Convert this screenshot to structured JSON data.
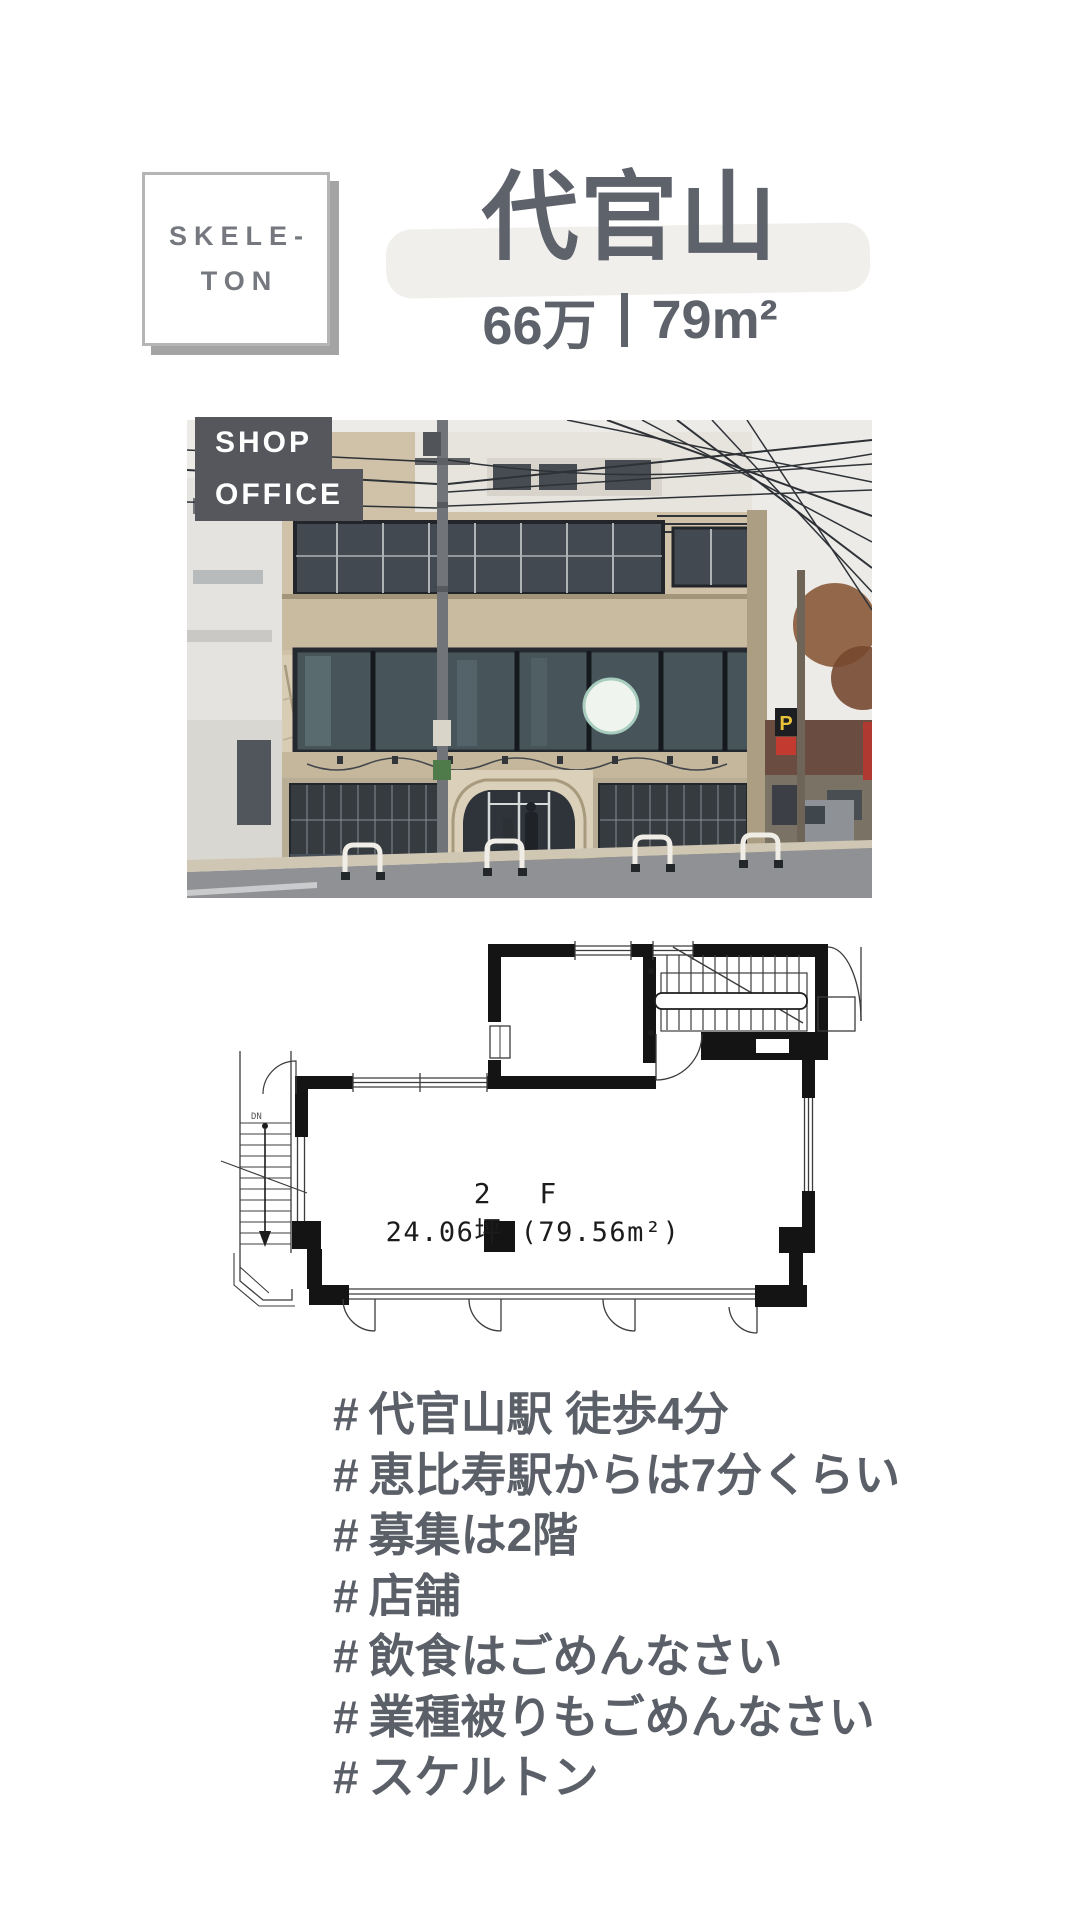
{
  "colors": {
    "text": "#5a5f68",
    "title_text": "#5e626b",
    "tag_background": "#55575c",
    "highlight": "#f0efeb",
    "badge_border": "#b5b5b5",
    "badge_shadow": "#a4a4a4",
    "badge_text": "#75787f",
    "plan_wall": "#141414",
    "parking_sign_yellow": "#e8c23a"
  },
  "badge": {
    "line1": "SKELE-",
    "line2": "TON"
  },
  "header": {
    "title": "代官山",
    "subtitle": "66万｜79㎡",
    "price": "66万",
    "area": "79m²"
  },
  "photo": {
    "tag_shop": "SHOP",
    "tag_office": "OFFICE",
    "parking_sign": "P"
  },
  "floorplan": {
    "floor_label": "2 F",
    "area_label": "24.06坪 (79.56m²)",
    "down_label": "DN"
  },
  "hashtags": {
    "symbol": "#",
    "items": [
      "代官山駅 徒歩4分",
      "恵比寿駅からは7分くらい",
      "募集は2階",
      "店舗",
      "飲食はごめんなさい",
      "業種被りもごめんなさい",
      "スケルトン"
    ]
  }
}
